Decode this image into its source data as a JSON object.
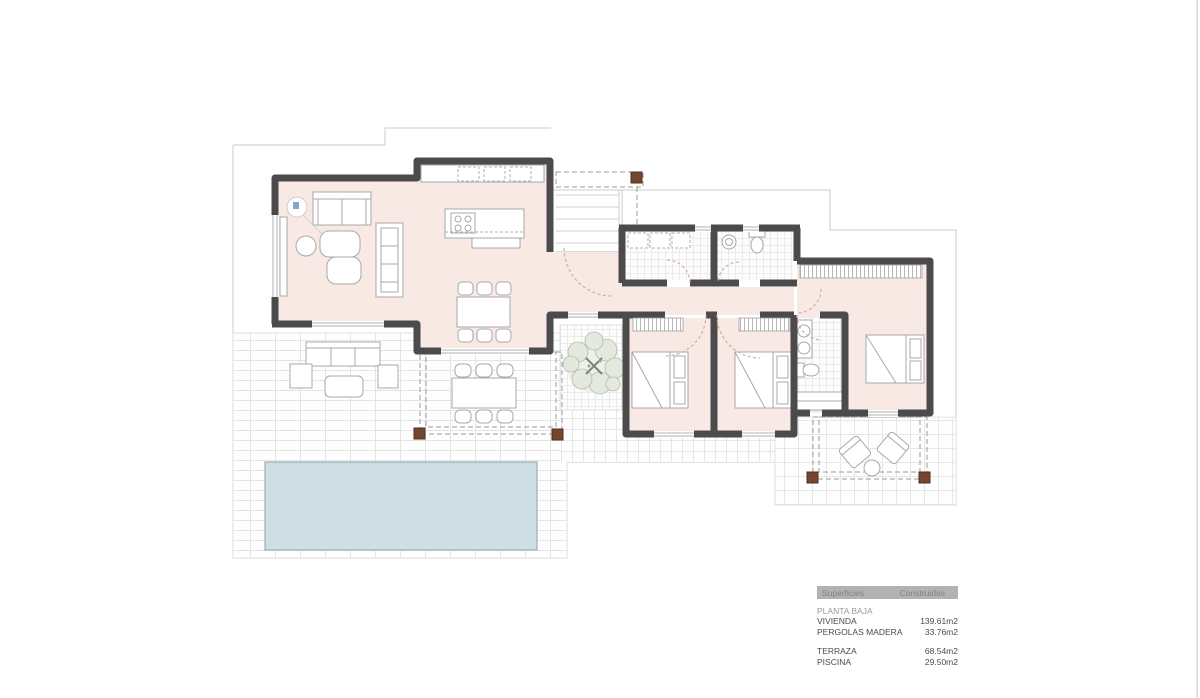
{
  "legend": {
    "header": {
      "col1": "Superficies",
      "col2": "Construidas"
    },
    "section": "PLANTA BAJA",
    "rows": [
      {
        "label": "VIVIENDA",
        "value": "139.61m2"
      },
      {
        "label": "PERGOLAS MADERA",
        "value": "33.76m2"
      },
      {
        "label": "TERRAZA",
        "value": "68.54m2"
      },
      {
        "label": "PISCINA",
        "value": "29.50m2"
      }
    ]
  },
  "colors": {
    "wall": "#4b4b4b",
    "interior_floor": "#f9e9e4",
    "pool_fill": "#cfdee3",
    "pool_border": "#9fb3ba",
    "pergola_post": "#74452f",
    "door_arc": "#d8ab9c",
    "property_line": "#cbcbcb",
    "tile_grid": "#e4e4e4",
    "legend_bar": "#b2b2b2",
    "text_dark": "#4a4a4a",
    "text_gray": "#8f8f8f"
  }
}
